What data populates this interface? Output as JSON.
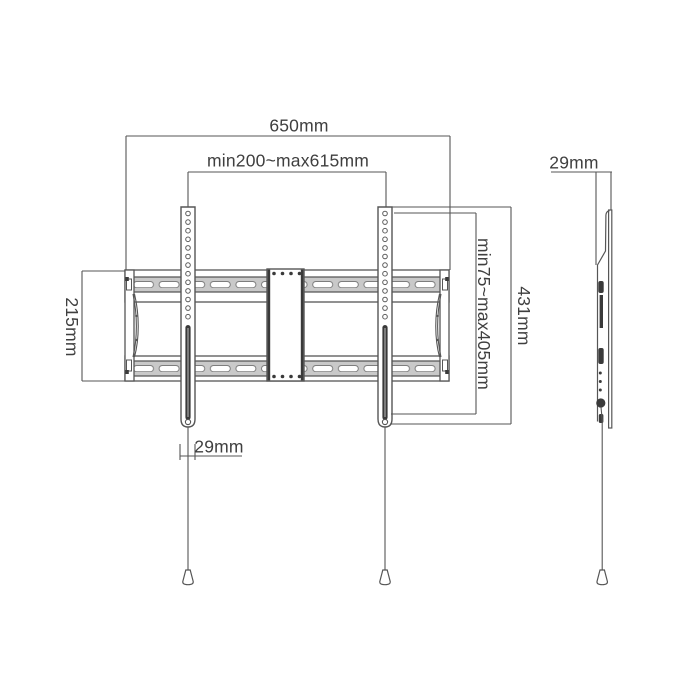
{
  "diagram": {
    "type": "technical-dimension-drawing",
    "subject": "fixed TV wall mount bracket, front view and side profile view",
    "labels": {
      "width_650": "650mm",
      "rail_span": "min200~max615mm",
      "plate_height": "215mm",
      "vesa_vertical": "min75~max405mm",
      "bracket_height": "431mm",
      "bracket_width": "29mm",
      "profile_depth": "29mm"
    },
    "colors": {
      "background": "#ffffff",
      "line": "#565656",
      "dark_fill": "#3a3a3a",
      "rail_strip": "#c9c9c9",
      "text": "#3f3f3f"
    }
  }
}
